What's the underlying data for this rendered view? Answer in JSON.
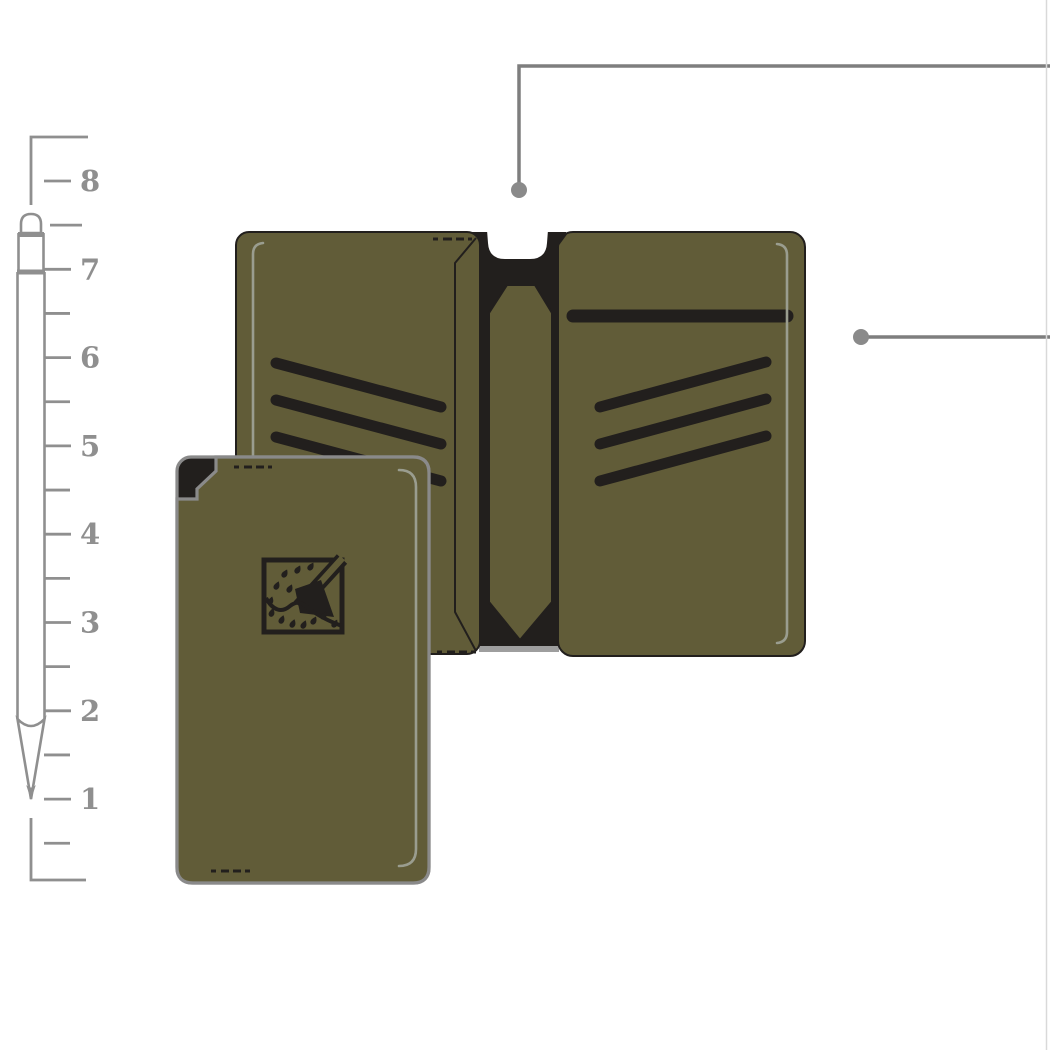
{
  "colors": {
    "bg": "#ffffff",
    "olive": "#615c38",
    "ink": "#221f1d",
    "gray": "#8f8f8f",
    "border-gray": "#8a8a8a",
    "stitch": "#9a9d8f",
    "shadow": "#9e9e9e",
    "callout": "#7e7e7e",
    "dot": "#8a8a8a",
    "edge": "#d9d9d9"
  },
  "ruler": {
    "numbers": [
      "8",
      "7",
      "6",
      "5",
      "4",
      "3",
      "2",
      "1"
    ],
    "top_number_y": 181,
    "unit_spacing_px": 88.3,
    "number_x": 80,
    "major_tick": {
      "x1": 44,
      "x2": 71
    },
    "minor_tick": {
      "x1": 44,
      "x2": 70
    },
    "first_minor_extra_offset": 6
  },
  "callouts": {
    "top": {
      "dot": {
        "x": 519,
        "y": 190
      },
      "elbow_y": 66,
      "end_x": 1052
    },
    "right": {
      "dot": {
        "x": 861,
        "y": 337
      },
      "end_x": 1052
    }
  },
  "wallet_open": {
    "left_card_slots": 3,
    "right_card_slots": 3,
    "bill_slots": 1,
    "thumb_notch": true,
    "center_strap": true
  },
  "wallet_front": {
    "logo": "axe-emblem",
    "corner_notch": true,
    "stitch_dashes": 4
  }
}
